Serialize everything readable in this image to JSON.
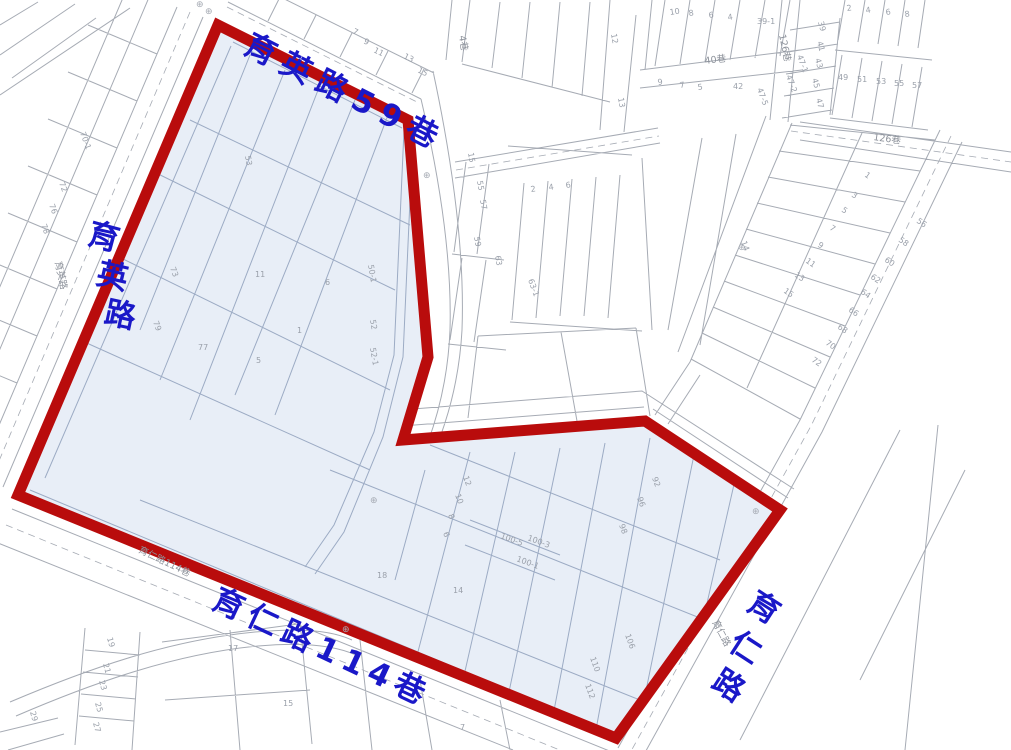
{
  "colors": {
    "boundary": "#b90c0c",
    "highlight_fill": "#e8eef7",
    "map_line": "#a6abb4",
    "highlight_line": "#9cabc4",
    "street_label": "#1a18c8",
    "sub_label": "#8d929b",
    "parcel_number": "#9aa0aa"
  },
  "streets": {
    "top": {
      "name": "育英路59巷",
      "label": {
        "t": "育英路59巷",
        "x": 242,
        "y": 52,
        "r": 27,
        "ls": 9
      }
    },
    "bottom": {
      "name": "育仁路114巷",
      "label": {
        "t": "育仁路114巷",
        "x": 210,
        "y": 607,
        "r": 25,
        "ls": 7
      }
    },
    "left": {
      "name": "育英路",
      "chars": [
        {
          "t": "育",
          "x": 86,
          "y": 243,
          "r": 15
        },
        {
          "t": "英",
          "x": 95,
          "y": 283,
          "r": 13
        },
        {
          "t": "路",
          "x": 103,
          "y": 322,
          "r": 12
        }
      ]
    },
    "right": {
      "name": "育仁路",
      "chars": [
        {
          "t": "育",
          "x": 745,
          "y": 608,
          "r": 33
        },
        {
          "t": "仁",
          "x": 727,
          "y": 648,
          "r": 33
        },
        {
          "t": "路",
          "x": 710,
          "y": 686,
          "r": 33
        }
      ]
    }
  },
  "road_sublabels": [
    {
      "t": "40巷",
      "x": 705,
      "y": 64,
      "r": -7
    },
    {
      "t": "126巷",
      "x": 873,
      "y": 140,
      "r": 8
    },
    {
      "t": "126巷",
      "x": 779,
      "y": 35,
      "r": 78
    },
    {
      "t": "4巷",
      "x": 459,
      "y": 36,
      "r": 80
    },
    {
      "t": "育仁路114巷",
      "x": 138,
      "y": 552,
      "r": 26
    },
    {
      "t": "育仁路",
      "x": 712,
      "y": 622,
      "r": 62
    },
    {
      "t": "育英路",
      "x": 55,
      "y": 262,
      "r": 78
    }
  ],
  "parcel_numbers": [
    {
      "t": "7",
      "x": 352,
      "y": 33,
      "r": 26
    },
    {
      "t": "9",
      "x": 363,
      "y": 43,
      "r": 26
    },
    {
      "t": "11",
      "x": 373,
      "y": 52,
      "r": 26
    },
    {
      "t": "13",
      "x": 403,
      "y": 58,
      "r": 26
    },
    {
      "t": "15",
      "x": 417,
      "y": 72,
      "r": 26
    },
    {
      "t": "10",
      "x": 670,
      "y": 15,
      "r": -8
    },
    {
      "t": "8",
      "x": 689,
      "y": 16,
      "r": -8
    },
    {
      "t": "6",
      "x": 709,
      "y": 18,
      "r": -8
    },
    {
      "t": "4",
      "x": 728,
      "y": 20,
      "r": -8
    },
    {
      "t": "39-1",
      "x": 757,
      "y": 24,
      "r": 0
    },
    {
      "t": "12",
      "x": 611,
      "y": 34,
      "r": 80
    },
    {
      "t": "13",
      "x": 618,
      "y": 98,
      "r": 80
    },
    {
      "t": "9",
      "x": 658,
      "y": 85,
      "r": -8
    },
    {
      "t": "7",
      "x": 680,
      "y": 88,
      "r": -8
    },
    {
      "t": "5",
      "x": 698,
      "y": 90,
      "r": -8
    },
    {
      "t": "42",
      "x": 733,
      "y": 89,
      "r": 0
    },
    {
      "t": "39",
      "x": 818,
      "y": 22,
      "r": 75
    },
    {
      "t": "41",
      "x": 817,
      "y": 42,
      "r": 75
    },
    {
      "t": "43",
      "x": 815,
      "y": 59,
      "r": 75
    },
    {
      "t": "45",
      "x": 812,
      "y": 79,
      "r": 75
    },
    {
      "t": "47",
      "x": 816,
      "y": 99,
      "r": 75
    },
    {
      "t": "2",
      "x": 847,
      "y": 11,
      "r": -8
    },
    {
      "t": "4",
      "x": 866,
      "y": 13,
      "r": -8
    },
    {
      "t": "6",
      "x": 886,
      "y": 15,
      "r": -8
    },
    {
      "t": "8",
      "x": 905,
      "y": 17,
      "r": -8
    },
    {
      "t": "49",
      "x": 838,
      "y": 80,
      "r": 0
    },
    {
      "t": "51",
      "x": 857,
      "y": 82,
      "r": 0
    },
    {
      "t": "53",
      "x": 876,
      "y": 84,
      "r": 0
    },
    {
      "t": "55",
      "x": 894,
      "y": 86,
      "r": 0
    },
    {
      "t": "57",
      "x": 912,
      "y": 88,
      "r": 0
    },
    {
      "t": "47-1",
      "x": 797,
      "y": 56,
      "r": 70
    },
    {
      "t": "47-2",
      "x": 786,
      "y": 76,
      "r": 70
    },
    {
      "t": "47-5",
      "x": 757,
      "y": 89,
      "r": 70
    },
    {
      "t": "14",
      "x": 741,
      "y": 242,
      "r": 70
    },
    {
      "t": "1",
      "x": 864,
      "y": 176,
      "r": 35
    },
    {
      "t": "3",
      "x": 851,
      "y": 196,
      "r": 35
    },
    {
      "t": "5",
      "x": 841,
      "y": 211,
      "r": 35
    },
    {
      "t": "7",
      "x": 829,
      "y": 229,
      "r": 35
    },
    {
      "t": "9",
      "x": 817,
      "y": 246,
      "r": 35
    },
    {
      "t": "11",
      "x": 805,
      "y": 262,
      "r": 35
    },
    {
      "t": "13",
      "x": 794,
      "y": 276,
      "r": 35
    },
    {
      "t": "15",
      "x": 783,
      "y": 292,
      "r": 35
    },
    {
      "t": "56",
      "x": 916,
      "y": 222,
      "r": 35
    },
    {
      "t": "58",
      "x": 898,
      "y": 241,
      "r": 35
    },
    {
      "t": "60",
      "x": 884,
      "y": 261,
      "r": 35
    },
    {
      "t": "62",
      "x": 870,
      "y": 278,
      "r": 35
    },
    {
      "t": "64",
      "x": 860,
      "y": 293,
      "r": 35
    },
    {
      "t": "66",
      "x": 848,
      "y": 311,
      "r": 35
    },
    {
      "t": "68",
      "x": 837,
      "y": 328,
      "r": 35
    },
    {
      "t": "70",
      "x": 825,
      "y": 344,
      "r": 35
    },
    {
      "t": "72",
      "x": 811,
      "y": 361,
      "r": 35
    },
    {
      "t": "15",
      "x": 468,
      "y": 153,
      "r": 80
    },
    {
      "t": "55",
      "x": 477,
      "y": 181,
      "r": 80
    },
    {
      "t": "57",
      "x": 480,
      "y": 200,
      "r": 80
    },
    {
      "t": "59",
      "x": 474,
      "y": 237,
      "r": 80
    },
    {
      "t": "63",
      "x": 495,
      "y": 256,
      "r": 80
    },
    {
      "t": "63-1",
      "x": 528,
      "y": 280,
      "r": 70
    },
    {
      "t": "2",
      "x": 531,
      "y": 192,
      "r": -8
    },
    {
      "t": "4",
      "x": 549,
      "y": 190,
      "r": -8
    },
    {
      "t": "6",
      "x": 566,
      "y": 188,
      "r": -8
    },
    {
      "t": "70-1",
      "x": 80,
      "y": 133,
      "r": 70
    },
    {
      "t": "72",
      "x": 59,
      "y": 183,
      "r": 70
    },
    {
      "t": "76",
      "x": 49,
      "y": 205,
      "r": 70
    },
    {
      "t": "78",
      "x": 41,
      "y": 225,
      "r": 70
    },
    {
      "t": "19",
      "x": 107,
      "y": 638,
      "r": 75
    },
    {
      "t": "21",
      "x": 103,
      "y": 664,
      "r": 75
    },
    {
      "t": "23",
      "x": 99,
      "y": 681,
      "r": 75
    },
    {
      "t": "25",
      "x": 95,
      "y": 703,
      "r": 75
    },
    {
      "t": "27",
      "x": 93,
      "y": 723,
      "r": 75
    },
    {
      "t": "29",
      "x": 30,
      "y": 712,
      "r": 75
    },
    {
      "t": "17",
      "x": 228,
      "y": 651,
      "r": 0
    },
    {
      "t": "15",
      "x": 283,
      "y": 706,
      "r": 0
    },
    {
      "t": "7",
      "x": 460,
      "y": 730,
      "r": 0
    },
    {
      "t": "53",
      "x": 245,
      "y": 156,
      "r": 80
    },
    {
      "t": "73",
      "x": 170,
      "y": 268,
      "r": 70
    },
    {
      "t": "11",
      "x": 255,
      "y": 277,
      "r": 0
    },
    {
      "t": "6",
      "x": 325,
      "y": 285,
      "r": 0
    },
    {
      "t": "1",
      "x": 297,
      "y": 333,
      "r": 0
    },
    {
      "t": "5",
      "x": 256,
      "y": 363,
      "r": 0
    },
    {
      "t": "79",
      "x": 153,
      "y": 322,
      "r": 70
    },
    {
      "t": "77",
      "x": 198,
      "y": 350,
      "r": 0
    },
    {
      "t": "50-1",
      "x": 368,
      "y": 265,
      "r": 80
    },
    {
      "t": "52",
      "x": 370,
      "y": 320,
      "r": 80
    },
    {
      "t": "52-1",
      "x": 370,
      "y": 348,
      "r": 80
    },
    {
      "t": "92",
      "x": 652,
      "y": 478,
      "r": 70
    },
    {
      "t": "96",
      "x": 637,
      "y": 498,
      "r": 70
    },
    {
      "t": "98",
      "x": 619,
      "y": 525,
      "r": 70
    },
    {
      "t": "106",
      "x": 625,
      "y": 635,
      "r": 70
    },
    {
      "t": "110",
      "x": 590,
      "y": 658,
      "r": 70
    },
    {
      "t": "112",
      "x": 585,
      "y": 685,
      "r": 70
    },
    {
      "t": "100-5",
      "x": 500,
      "y": 538,
      "r": 20
    },
    {
      "t": "100-3",
      "x": 527,
      "y": 540,
      "r": 20
    },
    {
      "t": "100-1",
      "x": 516,
      "y": 561,
      "r": 20
    },
    {
      "t": "12",
      "x": 463,
      "y": 477,
      "r": 70
    },
    {
      "t": "10",
      "x": 455,
      "y": 495,
      "r": 70
    },
    {
      "t": "8",
      "x": 448,
      "y": 515,
      "r": 70
    },
    {
      "t": "6",
      "x": 443,
      "y": 533,
      "r": 70
    },
    {
      "t": "18",
      "x": 377,
      "y": 578,
      "r": 0
    },
    {
      "t": "14",
      "x": 453,
      "y": 593,
      "r": 0
    }
  ],
  "survey_markers": [
    {
      "x": 196,
      "y": 7
    },
    {
      "x": 205,
      "y": 14
    },
    {
      "x": 423,
      "y": 178
    },
    {
      "x": 370,
      "y": 503
    },
    {
      "x": 342,
      "y": 632
    },
    {
      "x": 738,
      "y": 250
    },
    {
      "x": 752,
      "y": 514
    }
  ],
  "marker_glyph": "⊕"
}
